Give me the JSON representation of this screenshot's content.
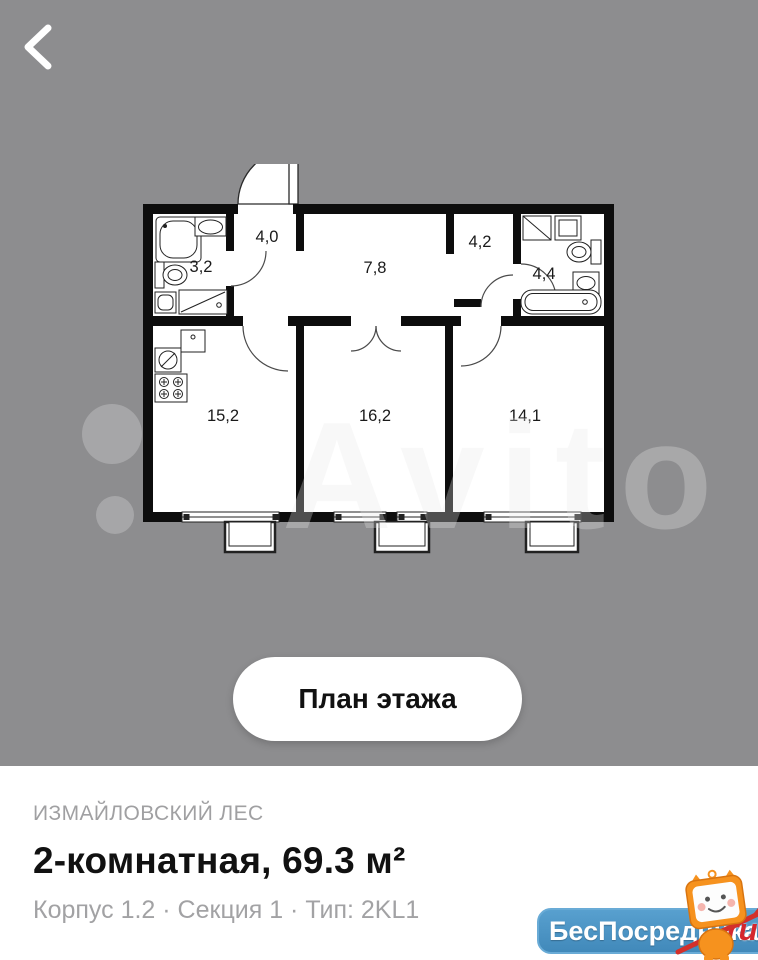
{
  "colors": {
    "background_gray": "#8d8d8f",
    "plan_walls": "#0d0d0d",
    "accent_blue_badge": "#4b93c4",
    "badge_red": "#d4272e",
    "mascot_orange": "#f6921e",
    "title_text": "#111111",
    "muted_text": "#a0a0a2"
  },
  "icons": {
    "back": "‹",
    "mascot": "tv-cat-mascot"
  },
  "photo": {
    "watermark": "Avito"
  },
  "plan": {
    "rooms": [
      {
        "id": "bathroom-small",
        "label": "3,2"
      },
      {
        "id": "entry-hall",
        "label": "4,0"
      },
      {
        "id": "corridor",
        "label": "7,8"
      },
      {
        "id": "wardrobe",
        "label": "4,2"
      },
      {
        "id": "bathroom",
        "label": "4,4"
      },
      {
        "id": "kitchen-living",
        "label": "15,2"
      },
      {
        "id": "bedroom-1",
        "label": "16,2"
      },
      {
        "id": "bedroom-2",
        "label": "14,1"
      }
    ]
  },
  "overlay_button": {
    "label": "План этажа"
  },
  "details": {
    "complex_name": "ИЗМАЙЛОВСКИЙ ЛЕС",
    "title": "2-комнатная, 69.3 м²",
    "subtitle": "Корпус 1.2 · Секция 1 · Тип: 2KL1"
  },
  "watermark_badge": {
    "text": "БесПосредника",
    "suffix": ".ru"
  }
}
